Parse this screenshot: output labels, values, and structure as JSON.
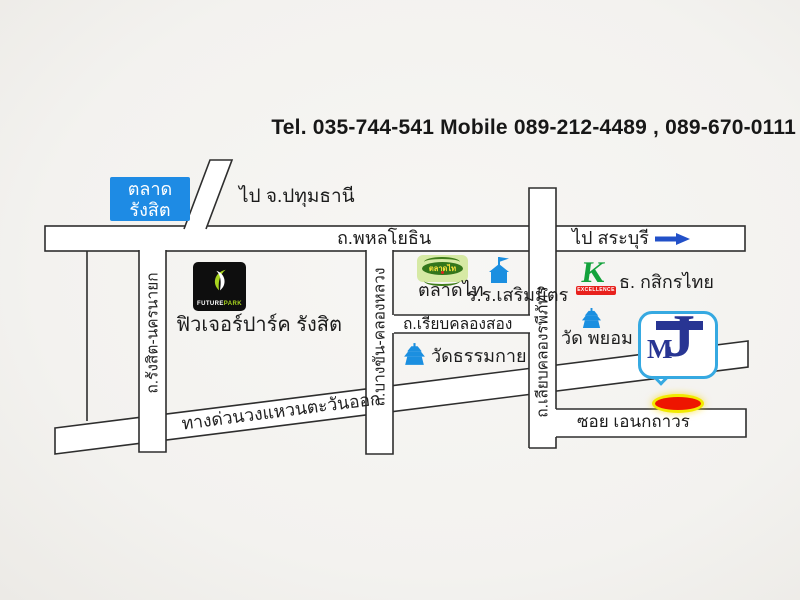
{
  "header": {
    "tel_line": "Tel. 035-744-541 Mobile 089-212-4489 , 089-670-0111"
  },
  "roads": {
    "phahonyothin": {
      "label": "ถ.พหลโยธิน"
    },
    "to_saraburi": {
      "label": "ไป สระบุรี"
    },
    "to_pathumthani": {
      "label": "ไป จ.ปทุมธานี"
    },
    "rangsit_nakhonnayok": {
      "label": "ถ.รังสิต-นครนายก"
    },
    "bangkhan_khlongluang": {
      "label": "ถ.บางขัน-คลองหลวง"
    },
    "liab_khlong_raphiphat": {
      "label": "ถ.เลียบคลองรพีภัทร"
    },
    "riab_khlong_song": {
      "label": "ถ.เรียบคลองสอง"
    },
    "expressway": {
      "label": "ทางด่วนวงแหวนตะวันออก"
    },
    "soi_anek_thavorn": {
      "label": "ซอย เอนกถาวร"
    }
  },
  "places": {
    "rangsit_market": {
      "line1": "ตลาด",
      "line2": "รังสิต",
      "color": "#1e8be4"
    },
    "future_park": {
      "label": "ฟิวเจอร์ปาร์ค รังสิต",
      "logo_white": "FUTURE",
      "logo_green": "PARK",
      "logo_bg": "#0e0e0e"
    },
    "talaad_thai": {
      "label": "ตลาดไท",
      "logo_text": "ตลาดไท",
      "logo_bg": "#d6e9a4",
      "logo_oval": "#33761b",
      "logo_text_color": "#f7e23c"
    },
    "serm_mit_school": {
      "label": "ร.ร.เสริมมิตร"
    },
    "wat_dhammakaya": {
      "label": "วัดธรรมกาย"
    },
    "kasikorn_bank": {
      "label": "ธ. กสิกรไทย",
      "logo_k": "K",
      "logo_banner": "EXCELLENCE",
      "green": "#13a23c",
      "red": "#e8211d"
    },
    "wat_phayom": {
      "label": "วัด พยอม"
    },
    "mj": {
      "letter_m": "M",
      "letter_j": "J",
      "border_color": "#36a9e1",
      "letter_color": "#283593"
    }
  },
  "colors": {
    "road_stroke": "#2e2e2e",
    "road_fill": "#ffffff",
    "icon_blue": "#1b8fe0",
    "arrow_blue": "#2250c8",
    "marker_red": "#ee1500",
    "marker_ring_yellow": "#f2ea00",
    "background": "#f3f2ef"
  }
}
